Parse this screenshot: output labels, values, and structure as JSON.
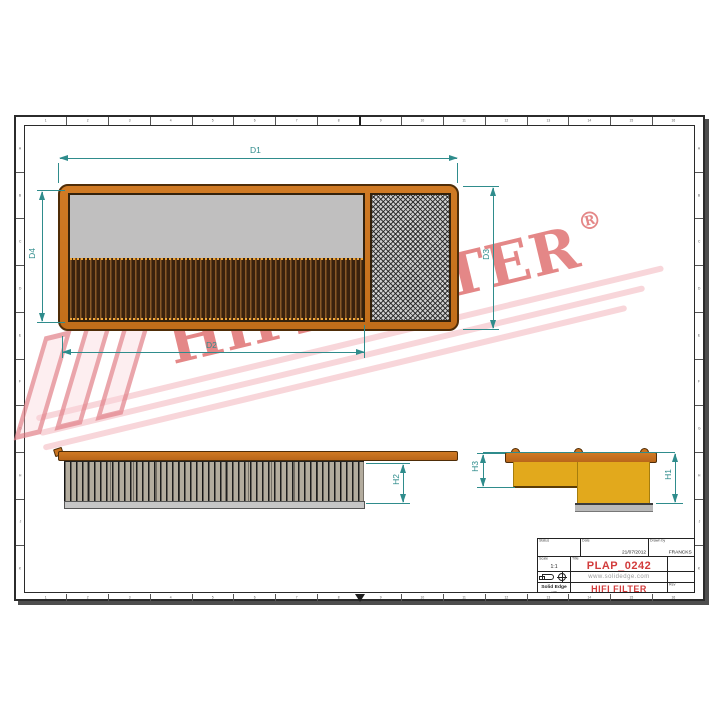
{
  "drawing": {
    "watermark": {
      "text": "HIFI FILTER",
      "registered": "®"
    },
    "dimensions": {
      "d1": "D1",
      "d2": "D2",
      "d3": "D3",
      "d4": "D4",
      "h1": "H1",
      "h2": "H2",
      "h3": "H3"
    }
  },
  "title_block": {
    "status_label": "Status",
    "date_label": "Date",
    "date_value": "21/07/2012",
    "drawn_label": "Drawn by",
    "drawn_value": "FRANCKS",
    "scale_label": "Scale",
    "scale_value": "1:1",
    "title_label": "Title",
    "title_value": "PLAP_0242",
    "url": "www.solidedge.com",
    "software_name": "Solid Edge",
    "software_version": "v20",
    "company": "HIFI FILTER",
    "rev_label": "Rev"
  },
  "frame": {
    "top_zones": [
      "1",
      "2",
      "3",
      "4",
      "5",
      "6",
      "7",
      "8",
      "9",
      "10",
      "11",
      "12",
      "13",
      "14",
      "15",
      "16"
    ],
    "bottom_zones": [
      "1",
      "2",
      "3",
      "4",
      "5",
      "6",
      "7",
      "8",
      "9",
      "10",
      "11",
      "12",
      "13",
      "14",
      "15",
      "16"
    ],
    "left_zones": [
      "A",
      "B",
      "C",
      "D",
      "E",
      "F",
      "G",
      "H",
      "J",
      "K"
    ],
    "right_zones": [
      "A",
      "B",
      "C",
      "D",
      "E",
      "F",
      "G",
      "H",
      "J",
      "K"
    ]
  },
  "colors": {
    "dimension": "#2f8c8c",
    "frame_orange": "#c9731f",
    "body_yellow": "#e2a91c",
    "brand_red": "#d23c3c"
  }
}
